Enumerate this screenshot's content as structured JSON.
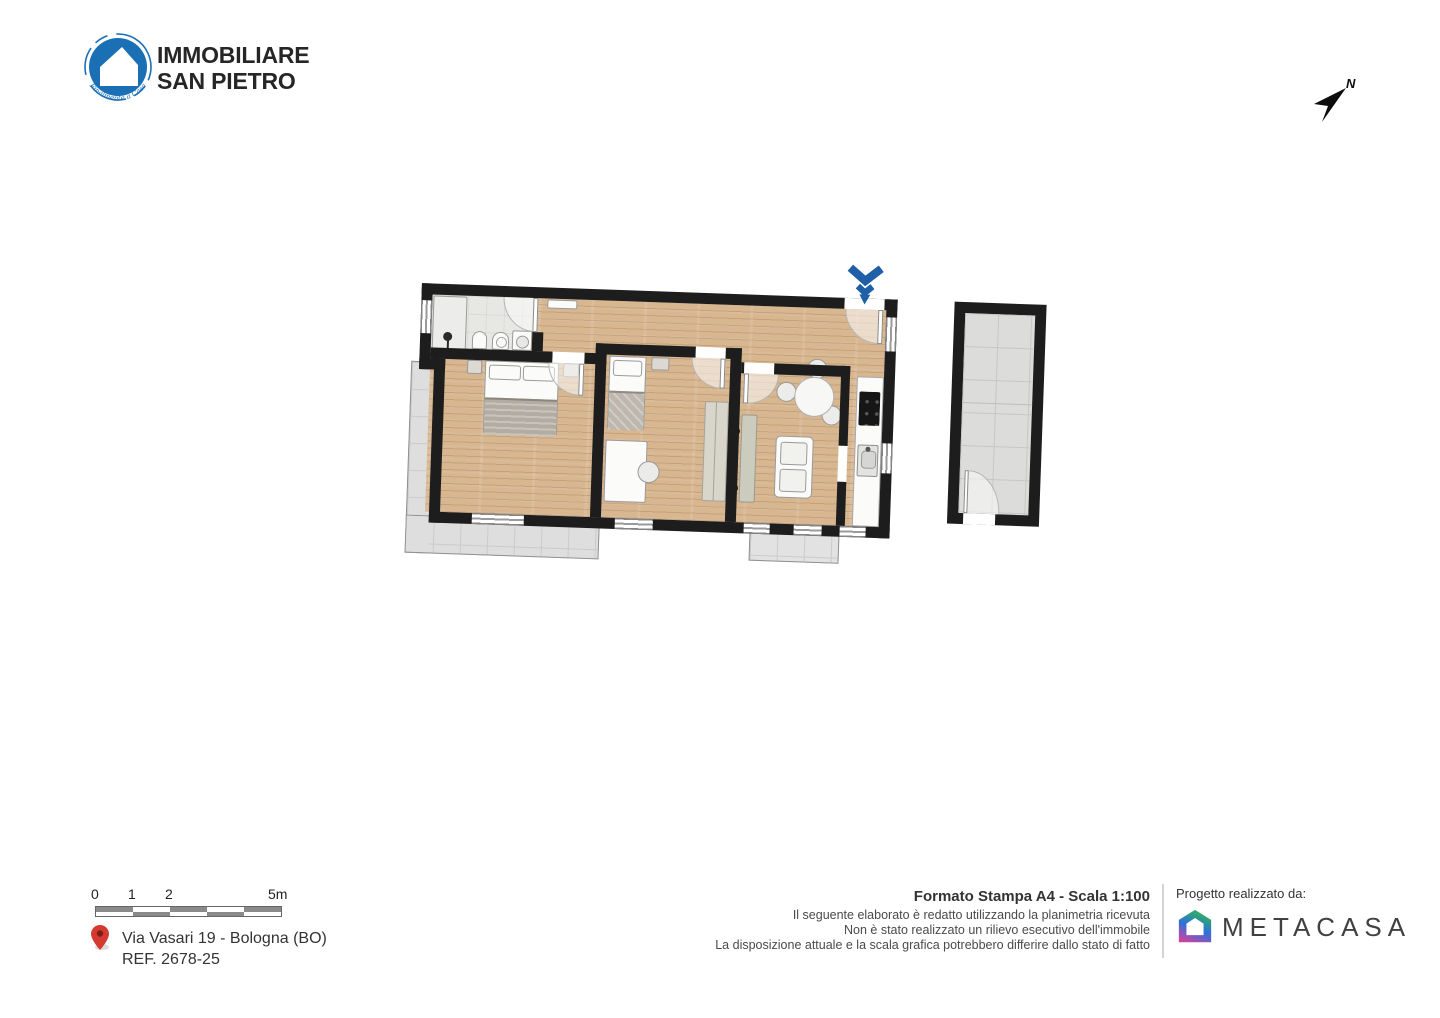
{
  "branding": {
    "line1": "IMMOBILIARE",
    "line2": "SAN PIETRO",
    "tagline": "Finalmente a Casa"
  },
  "compass": {
    "label": "N"
  },
  "floorplan": {
    "type": "apartment-floor-plan",
    "rooms": [
      "bathroom",
      "hallway",
      "double-bedroom",
      "single-bedroom",
      "living-room",
      "kitchen"
    ],
    "outdoor": [
      "terrace",
      "balcony"
    ],
    "annex": [
      "cellar"
    ],
    "entry_marker": "double-chevron-down"
  },
  "scalebar": {
    "labels": [
      "0",
      "1",
      "2",
      "5m"
    ]
  },
  "location": {
    "address": "Via Vasari 19 - Bologna (BO)",
    "reference": "REF. 2678-25"
  },
  "print": {
    "title": "Formato Stampa A4 - Scala 1:100",
    "disclaimer_lines": [
      "Il seguente elaborato è redatto utilizzando la planimetria ricevuta",
      "Non è stato realizzato un rilievo esecutivo dell'immobile",
      "La disposizione attuale e la scala grafica potrebbero differire dallo stato di fatto"
    ]
  },
  "credits": {
    "label": "Progetto realizzato da:",
    "brand": "METACASA"
  },
  "colors": {
    "logo_blue": "#1a6fb5",
    "entry_marker_blue": "#1e5fa6",
    "pin_red": "#d43a2f",
    "wall": "#1d1d1d",
    "wood_floor": "#d7b690",
    "tile_gray": "#dedede",
    "metacasa_green": "#2eb457",
    "metacasa_blue": "#2e6fdd",
    "metacasa_pink": "#d6409b"
  },
  "icons": {
    "logo": "house-in-blue-circle-icon",
    "compass": "north-arrow-icon",
    "entry": "double-chevron-down-icon",
    "address": "map-pin-icon",
    "credits": "gradient-house-icon"
  }
}
